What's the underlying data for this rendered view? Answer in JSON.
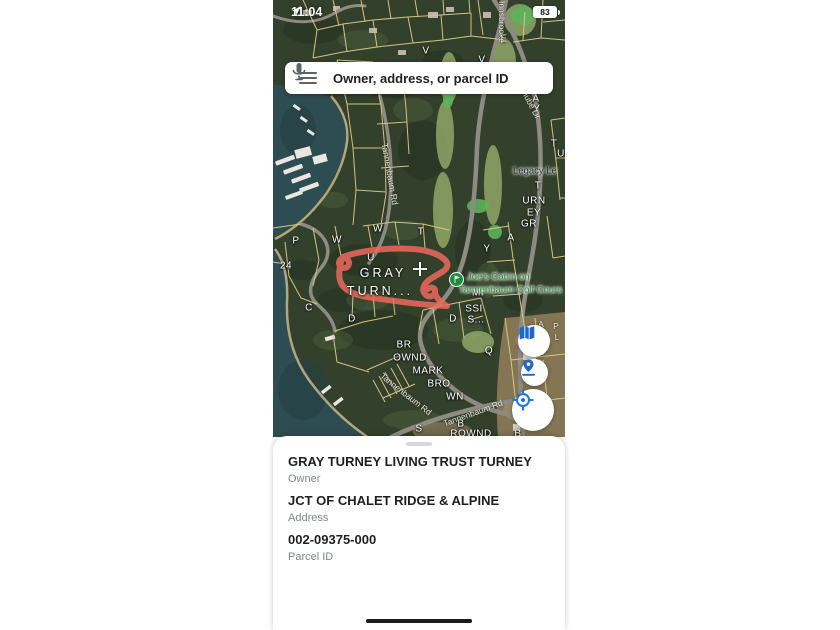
{
  "status_bar": {
    "time": "11:04",
    "battery": "83"
  },
  "search": {
    "placeholder": "Owner, address, or parcel ID"
  },
  "map": {
    "selected_parcel_label": "GRAY TURN...",
    "poi": {
      "line1": "Joe's Cabin on",
      "line2": "Tannenbaum Golf Cours"
    },
    "labels": [
      {
        "text": "V",
        "x": 153,
        "y": 51,
        "cls": "parcel"
      },
      {
        "text": "V",
        "x": 209,
        "y": 60,
        "cls": "parcel"
      },
      {
        "text": "E",
        "x": 231,
        "y": 39,
        "cls": "parcel"
      },
      {
        "text": "W",
        "x": 105,
        "y": 229,
        "cls": "parcel"
      },
      {
        "text": "P",
        "x": 23,
        "y": 241,
        "cls": "parcel"
      },
      {
        "text": "W",
        "x": 64,
        "y": 240,
        "cls": "parcel"
      },
      {
        "text": "U",
        "x": 98,
        "y": 258,
        "cls": "parcel"
      },
      {
        "text": "24",
        "x": 13,
        "y": 266,
        "cls": "parcel"
      },
      {
        "text": "C",
        "x": 36,
        "y": 308,
        "cls": "parcel"
      },
      {
        "text": "D",
        "x": 79,
        "y": 319,
        "cls": "parcel"
      },
      {
        "text": "T",
        "x": 148,
        "y": 232,
        "cls": "parcel"
      },
      {
        "text": "Y",
        "x": 214,
        "y": 249,
        "cls": "parcel"
      },
      {
        "text": "A",
        "x": 238,
        "y": 238,
        "cls": "parcel"
      },
      {
        "text": "R",
        "x": 262,
        "y": 89,
        "cls": "parcel"
      },
      {
        "text": "A",
        "x": 263,
        "y": 99,
        "cls": "parcel"
      },
      {
        "text": "Y",
        "x": 264,
        "y": 109,
        "cls": "parcel"
      },
      {
        "text": "T",
        "x": 281,
        "y": 144,
        "cls": "parcel"
      },
      {
        "text": "U",
        "x": 288,
        "y": 154,
        "cls": "parcel"
      },
      {
        "text": "T",
        "x": 265,
        "y": 186,
        "cls": "parcel"
      },
      {
        "text": "URN",
        "x": 261,
        "y": 201,
        "cls": "parcel"
      },
      {
        "text": "EY",
        "x": 261,
        "y": 213,
        "cls": "parcel"
      },
      {
        "text": "GR",
        "x": 256,
        "y": 224,
        "cls": "parcel"
      },
      {
        "text": "MI",
        "x": 205,
        "y": 293,
        "cls": "parcel"
      },
      {
        "text": "SSI",
        "x": 201,
        "y": 309,
        "cls": "parcel"
      },
      {
        "text": "S...",
        "x": 203,
        "y": 320,
        "cls": "parcel"
      },
      {
        "text": "D",
        "x": 180,
        "y": 319,
        "cls": "parcel"
      },
      {
        "text": "Q",
        "x": 216,
        "y": 351,
        "cls": "parcel"
      },
      {
        "text": "BR",
        "x": 131,
        "y": 345,
        "cls": "parcel"
      },
      {
        "text": "OWND",
        "x": 137,
        "y": 358,
        "cls": "parcel"
      },
      {
        "text": "MARK",
        "x": 155,
        "y": 371,
        "cls": "parcel"
      },
      {
        "text": "BRO",
        "x": 166,
        "y": 384,
        "cls": "parcel"
      },
      {
        "text": "WN",
        "x": 182,
        "y": 397,
        "cls": "parcel"
      },
      {
        "text": "S",
        "x": 146,
        "y": 429,
        "cls": "parcel"
      },
      {
        "text": "B",
        "x": 188,
        "y": 424,
        "cls": "parcel"
      },
      {
        "text": "ROWND",
        "x": 198,
        "y": 434,
        "cls": "parcel"
      },
      {
        "text": "B",
        "x": 245,
        "y": 434,
        "cls": "parcel"
      },
      {
        "text": "A",
        "x": 268,
        "y": 324,
        "cls": "parcel-sm"
      },
      {
        "text": "N",
        "x": 269,
        "y": 341,
        "cls": "parcel-sm"
      },
      {
        "text": "E",
        "x": 268,
        "y": 352,
        "cls": "parcel-sm"
      },
      {
        "text": "P",
        "x": 283,
        "y": 326,
        "cls": "parcel-sm"
      },
      {
        "text": "L",
        "x": 284,
        "y": 337,
        "cls": "parcel-sm"
      },
      {
        "text": "GRAY",
        "x": 110,
        "y": 273,
        "cls": "sel"
      },
      {
        "text": "TURN...",
        "x": 107,
        "y": 291,
        "cls": "sel"
      },
      {
        "text": "Tannenbaum Rd",
        "x": 117,
        "y": 174,
        "cls": "street",
        "rot": 80
      },
      {
        "text": "Tannenbaum Rd",
        "x": 133,
        "y": 394,
        "cls": "street",
        "rot": 38
      },
      {
        "text": "Tannenbaum Rd",
        "x": 200,
        "y": 413,
        "cls": "street",
        "rot": -20
      },
      {
        "text": "Innsbrooke",
        "x": 229,
        "y": 22,
        "cls": "street",
        "rot": 90
      },
      {
        "text": "Danube Dr",
        "x": 256,
        "y": 100,
        "cls": "street",
        "rot": 62
      },
      {
        "text": "Legacy Le",
        "x": 240,
        "y": 171,
        "cls": "street-dark",
        "anchor": "left"
      },
      {
        "text": "Joe's Cabin on",
        "x": 194,
        "y": 277,
        "cls": "poi",
        "anchor": "left"
      },
      {
        "text": "Tannenbaum Golf Cours",
        "x": 186,
        "y": 290,
        "cls": "poi",
        "anchor": "left"
      }
    ],
    "controls": [
      {
        "name": "map-layers-button"
      },
      {
        "name": "drop-pin-button"
      },
      {
        "name": "my-location-button"
      }
    ],
    "colors": {
      "accent_blue": "#1a73e8",
      "selected_parcel_outline": "#ee6a5c",
      "parcel_line": "#dcca82",
      "poi_green": "#2f8d3c",
      "water": "#2e4d52"
    }
  },
  "bottom_sheet": {
    "fields": [
      {
        "value": "GRAY TURNEY LIVING TRUST TURNEY",
        "label": "Owner"
      },
      {
        "value": "JCT OF CHALET RIDGE & ALPINE",
        "label": "Address"
      },
      {
        "value": "002-09375-000",
        "label": "Parcel ID"
      }
    ]
  }
}
